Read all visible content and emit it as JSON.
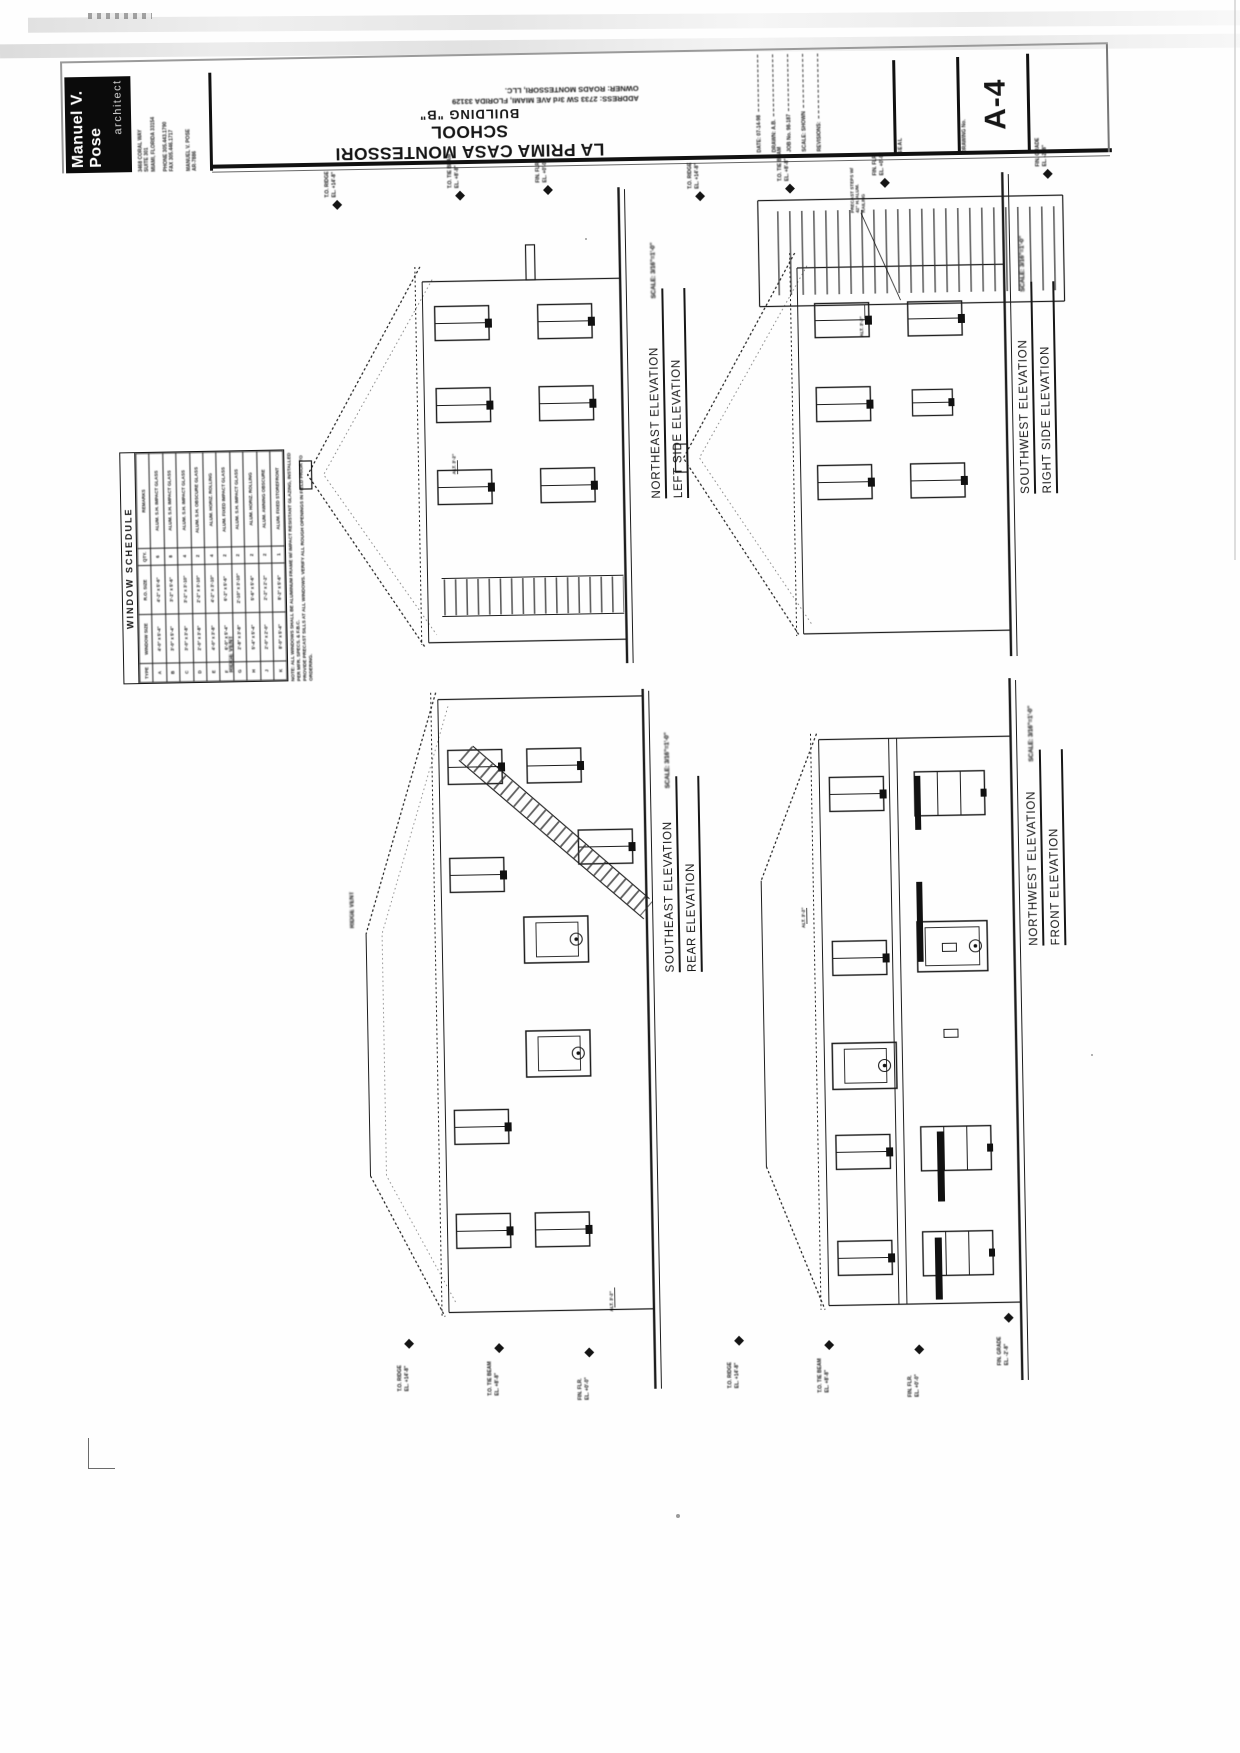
{
  "logo": {
    "name_line1": "Manuel V.",
    "name_line2": "Pose",
    "profession": "architect"
  },
  "firm": {
    "address": [
      "3468 CORAL WAY",
      "SUITE 301",
      "MIAMI, FLORIDA 33154"
    ],
    "contact": [
      "PHONE 305.443.1790",
      "FAX 305.446.1717"
    ],
    "registration": [
      "MANUEL V. POSE",
      "AR-7886"
    ]
  },
  "title_block": {
    "owner": "OWNER: ROADS MONTESSORI, LLC.",
    "address": "ADDRESS: 2733 SW 3rd AVE  MIAMI, FLORIDA 33129",
    "building": "BUILDING \"B\"",
    "project": "LA PRIMA CASA MONTESSORI SCHOOL",
    "fields": {
      "date": "DATE: 07-14-98",
      "drawn": "DRAWN: A.B.",
      "job": "JOB No. 98-187",
      "scale": "SCALE: SHOWN",
      "revisions": "REVISIONS:"
    },
    "seal_label": "SEAL",
    "drawing_no_label": "DRAWING No.",
    "sheet_number": "A-4"
  },
  "drawings": {
    "northeast": {
      "title": "NORTHEAST ELEVATION",
      "subtitle": "LEFT SIDE ELEVATION",
      "scale": "SCALE: 3/16\"=1'-0\"",
      "ridge_note": "RIDGE VENT",
      "dim_note": "ALT. 3'-2\"",
      "markers": [
        {
          "l1": "T.O. RIDGE",
          "l2": "EL. +14'-8\""
        },
        {
          "l1": "T.O. TIE BEAM",
          "l2": "EL. +8'-8\""
        },
        {
          "l1": "FIN. FLR.",
          "l2": "EL. +0'-0\""
        }
      ]
    },
    "southwest": {
      "title": "SOUTHWEST ELEVATION",
      "subtitle": "RIGHT SIDE ELEVATION",
      "scale": "SCALE: 3/16\"=1'-0\"",
      "stair_note_l1": "PRECAST STEPS W/",
      "stair_note_l2": "42\" H. ALUM. RAILING",
      "dim_note": "ALT. 3'-2\"",
      "markers": [
        {
          "l1": "T.O. RIDGE",
          "l2": "EL. +14'-8\""
        },
        {
          "l1": "T.O. TIE BEAM",
          "l2": "EL. +8'-8\""
        },
        {
          "l1": "FIN. FLR.",
          "l2": "EL. +0'-0\""
        },
        {
          "l1": "FIN. GRADE",
          "l2": "EL. -2'-8\""
        }
      ]
    },
    "southeast": {
      "title": "SOUTHEAST ELEVATION",
      "subtitle": "REAR ELEVATION",
      "scale": "SCALE: 3/16\"=1'-0\"",
      "ridge_note": "RIDGE VENT",
      "dim_note": "ALT. 3'-2\"",
      "markers": [
        {
          "l1": "T.O. RIDGE",
          "l2": "EL. +14'-8\""
        },
        {
          "l1": "T.O. TIE BEAM",
          "l2": "EL. +8'-8\""
        },
        {
          "l1": "FIN. FLR.",
          "l2": "EL. +0'-0\""
        }
      ]
    },
    "northwest": {
      "title": "NORTHWEST ELEVATION",
      "subtitle": "FRONT ELEVATION",
      "scale": "SCALE: 3/16\"=1'-0\"",
      "dim_note": "ALT. 3'-2\"",
      "markers": [
        {
          "l1": "T.O. RIDGE",
          "l2": "EL. +14'-8\""
        },
        {
          "l1": "T.O. TIE BEAM",
          "l2": "EL. +8'-8\""
        },
        {
          "l1": "FIN. FLR.",
          "l2": "EL. +0'-0\""
        },
        {
          "l1": "FIN. GRADE",
          "l2": "EL. -2'-8\""
        }
      ]
    }
  },
  "window_schedule": {
    "title": "WINDOW SCHEDULE",
    "columns": [
      "TYPE",
      "WINDOW SIZE",
      "R.O. SIZE",
      "QTY.",
      "REMARKS"
    ],
    "rows": [
      [
        "A",
        "4'-0\" x 5'-4\"",
        "4'-2\" x 5'-6\"",
        "6",
        "ALUM. S.H. IMPACT GLASS"
      ],
      [
        "B",
        "3'-0\" x 5'-4\"",
        "3'-2\" x 5'-6\"",
        "8",
        "ALUM. S.H. IMPACT GLASS"
      ],
      [
        "C",
        "3'-0\" x 3'-8\"",
        "3'-2\" x 3'-10\"",
        "4",
        "ALUM. S.H. IMPACT GLASS"
      ],
      [
        "D",
        "2'-0\" x 3'-8\"",
        "2'-2\" x 3'-10\"",
        "2",
        "ALUM. S.H. OBSCURE GLASS"
      ],
      [
        "E",
        "4'-0\" x 3'-8\"",
        "4'-2\" x 3'-10\"",
        "4",
        "ALUM. HORIZ. ROLLING"
      ],
      [
        "F",
        "6'-0\" x 5'-4\"",
        "6'-2\" x 5'-6\"",
        "2",
        "ALUM. FIXED IMPACT GLASS"
      ],
      [
        "G",
        "2'-8\" x 3'-8\"",
        "2'-10\" x 3'-10\"",
        "2",
        "ALUM. S.H. IMPACT GLASS"
      ],
      [
        "H",
        "5'-4\" x 5'-4\"",
        "5'-6\" x 5'-6\"",
        "2",
        "ALUM. HORIZ. ROLLING"
      ],
      [
        "J",
        "2'-0\" x 2'-0\"",
        "2'-2\" x 2'-2\"",
        "2",
        "ALUM. AWNING OBSCURE"
      ],
      [
        "K",
        "8'-0\" x 5'-4\"",
        "8'-2\" x 5'-6\"",
        "1",
        "ALUM. FIXED STOREFRONT"
      ]
    ],
    "notes": [
      "NOTE: ALL WINDOWS SHALL BE ALUMINUM FRAME W/ IMPACT RESISTANT GLAZING, INSTALLED PER MFR. SPECS. & F.B.C.",
      "PROVIDE PRECAST SILLS AT ALL WINDOWS. VERIFY ALL ROUGH OPENINGS IN FIELD PRIOR TO ORDERING."
    ]
  }
}
